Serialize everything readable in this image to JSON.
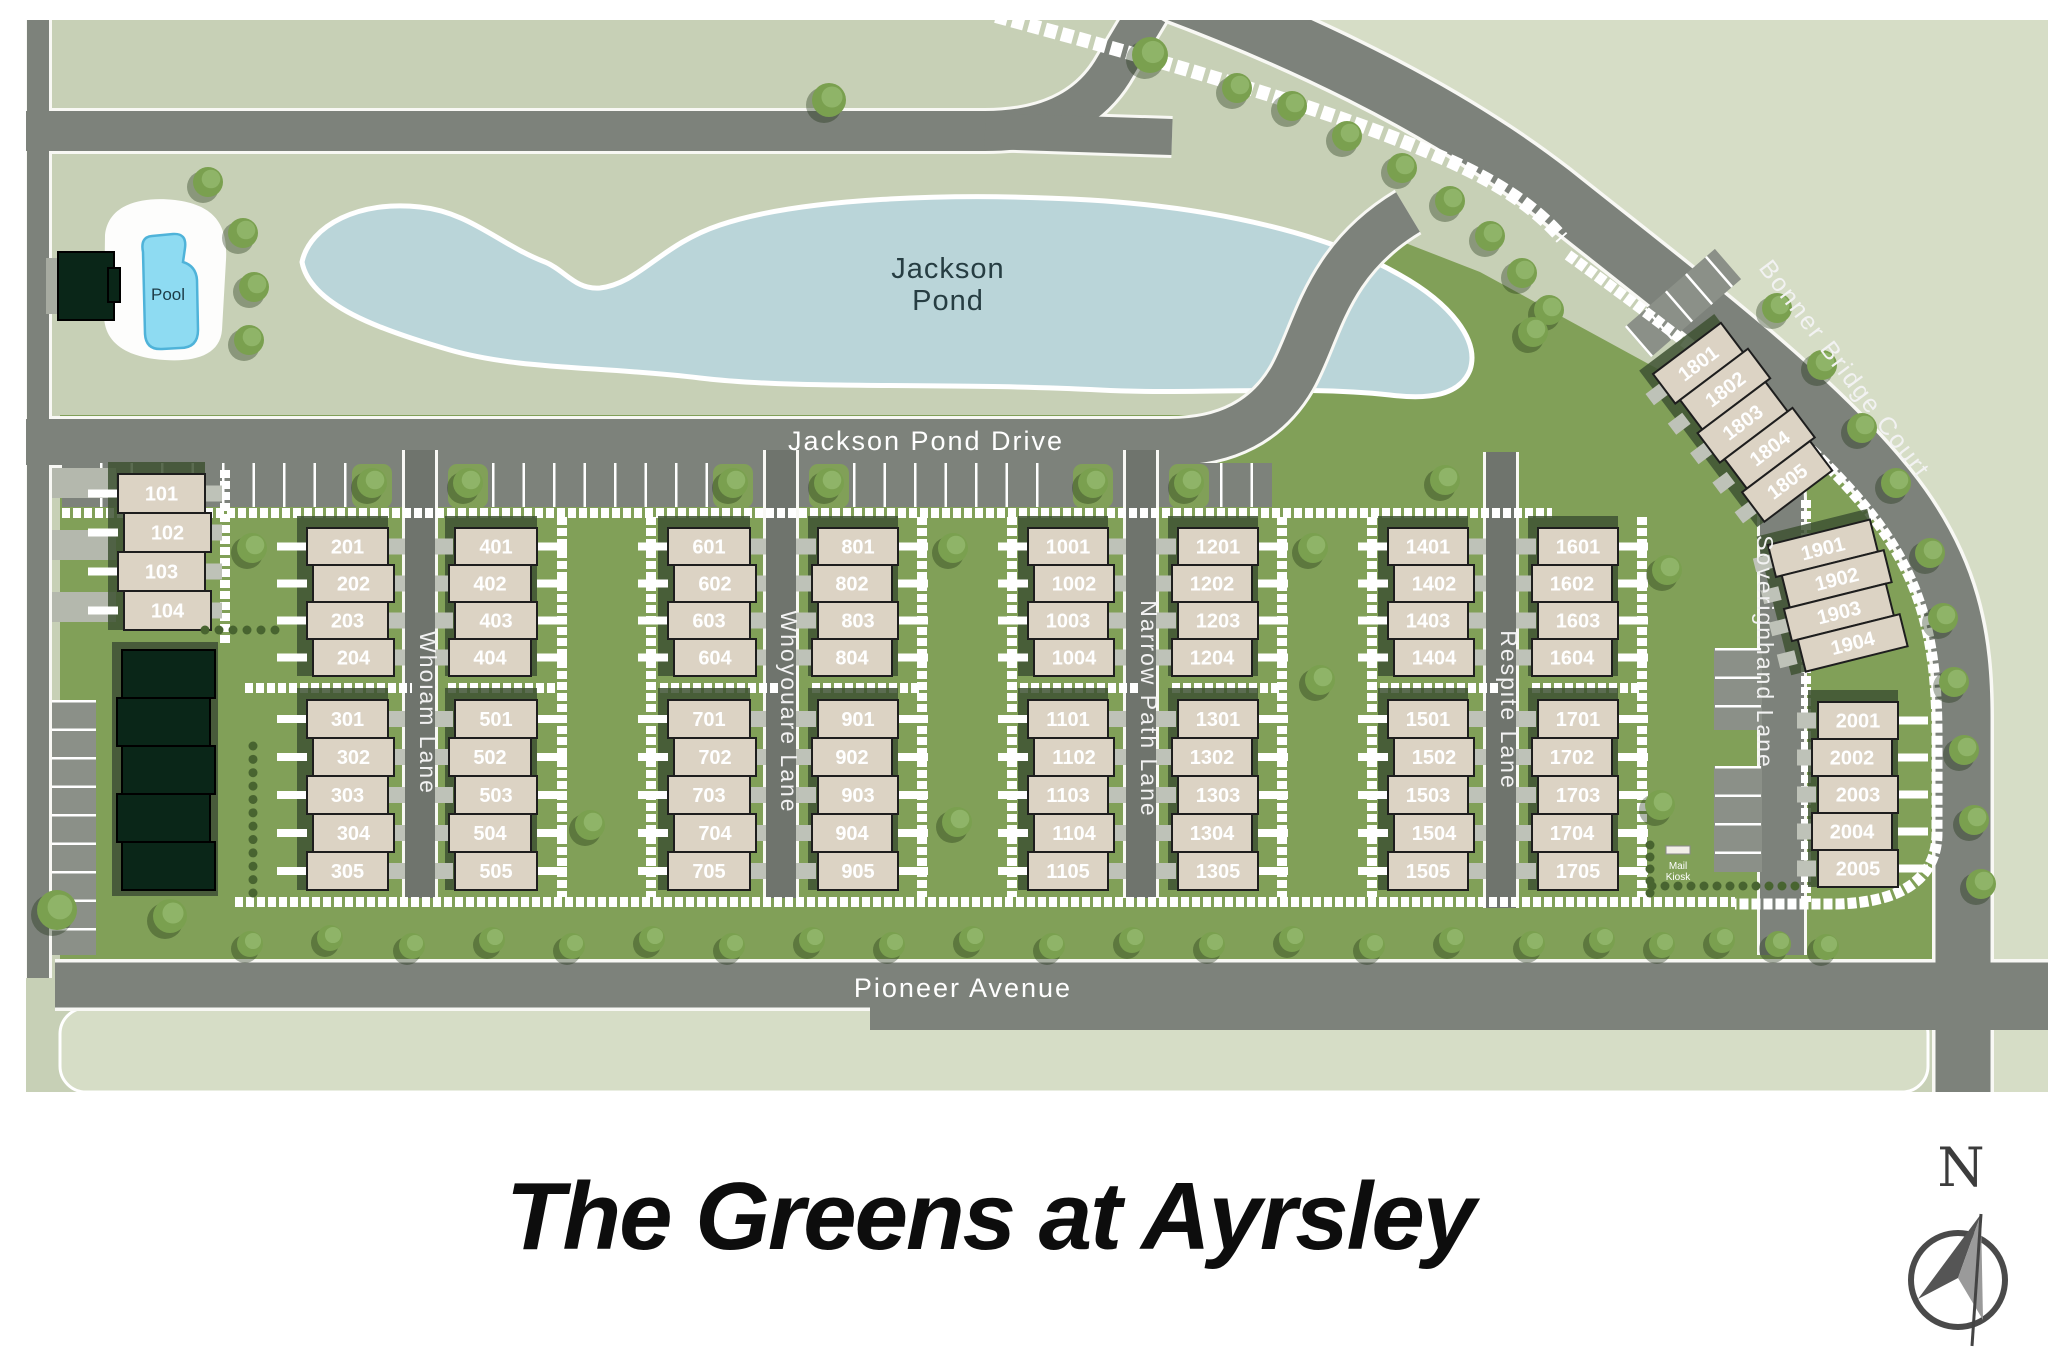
{
  "title": "The Greens at Ayrsley",
  "compass": {
    "north_label": "N"
  },
  "map": {
    "pond_label_line1": "Jackson",
    "pond_label_line2": "Pond",
    "pool_label": "Pool",
    "mail_kiosk_label_line1": "Mail",
    "mail_kiosk_label_line2": "Kiosk",
    "streets": {
      "jackson_pond_drive": "Jackson Pond Drive",
      "pioneer_avenue": "Pioneer Avenue",
      "whoiam_lane": "Whoiam Lane",
      "whoyouare_lane": "Whoyouare Lane",
      "narrow_path_lane": "Narrow Path Lane",
      "respite_lane": "Respite Lane",
      "soverignhand_lane": "Soverignhand Lane",
      "bonner_bridge_court": "Bonner Bridge Court"
    },
    "blocks": [
      {
        "id": "b101",
        "units": [
          "101",
          "102",
          "103",
          "104"
        ]
      },
      {
        "id": "b201",
        "units": [
          "201",
          "202",
          "203",
          "204"
        ]
      },
      {
        "id": "b301",
        "units": [
          "301",
          "302",
          "303",
          "304",
          "305"
        ]
      },
      {
        "id": "b401",
        "units": [
          "401",
          "402",
          "403",
          "404"
        ]
      },
      {
        "id": "b501",
        "units": [
          "501",
          "502",
          "503",
          "504",
          "505"
        ]
      },
      {
        "id": "b601",
        "units": [
          "601",
          "602",
          "603",
          "604"
        ]
      },
      {
        "id": "b701",
        "units": [
          "701",
          "702",
          "703",
          "704",
          "705"
        ]
      },
      {
        "id": "b801",
        "units": [
          "801",
          "802",
          "803",
          "804"
        ]
      },
      {
        "id": "b901",
        "units": [
          "901",
          "902",
          "903",
          "904",
          "905"
        ]
      },
      {
        "id": "b1001",
        "units": [
          "1001",
          "1002",
          "1003",
          "1004"
        ]
      },
      {
        "id": "b1101",
        "units": [
          "1101",
          "1102",
          "1103",
          "1104",
          "1105"
        ]
      },
      {
        "id": "b1201",
        "units": [
          "1201",
          "1202",
          "1203",
          "1204"
        ]
      },
      {
        "id": "b1301",
        "units": [
          "1301",
          "1302",
          "1303",
          "1304",
          "1305"
        ]
      },
      {
        "id": "b1401",
        "units": [
          "1401",
          "1402",
          "1403",
          "1404"
        ]
      },
      {
        "id": "b1501",
        "units": [
          "1501",
          "1502",
          "1503",
          "1504",
          "1505"
        ]
      },
      {
        "id": "b1601",
        "units": [
          "1601",
          "1602",
          "1603",
          "1604"
        ]
      },
      {
        "id": "b1701",
        "units": [
          "1701",
          "1702",
          "1703",
          "1704",
          "1705"
        ]
      },
      {
        "id": "b1801",
        "units": [
          "1801",
          "1802",
          "1803",
          "1804",
          "1805"
        ]
      },
      {
        "id": "b1901",
        "units": [
          "1901",
          "1902",
          "1903",
          "1904"
        ]
      },
      {
        "id": "b2001",
        "units": [
          "2001",
          "2002",
          "2003",
          "2004",
          "2005"
        ]
      }
    ],
    "colors": {
      "background_sage": "#c7d0b6",
      "pale_sage": "#d6ddc6",
      "site_green": "#81a058",
      "road_gray": "#7d827b",
      "lane_gray": "#6f746d",
      "pond_water": "#bad5d9",
      "pool_water": "#8edbf2",
      "building_beige": "#dcd3c4",
      "dark_building_green": "#0a2618"
    }
  }
}
